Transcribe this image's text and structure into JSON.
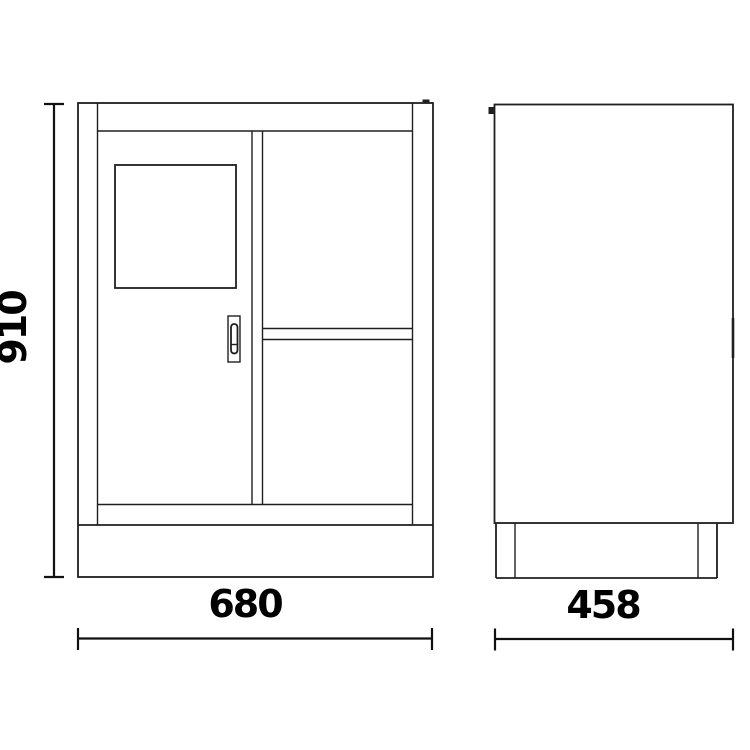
{
  "page": {
    "background": "#ffffff"
  },
  "drawing": {
    "colors": {
      "line": "#1f1f1f",
      "text": "#000000",
      "background": "#ffffff"
    },
    "views": {
      "front_view": {
        "name": "cabinet-front-view"
      },
      "side_view": {
        "name": "cabinet-side-view"
      }
    },
    "dimensions": {
      "height": {
        "label": "910"
      },
      "width": {
        "label": "680"
      },
      "depth": {
        "label": "458"
      }
    }
  }
}
